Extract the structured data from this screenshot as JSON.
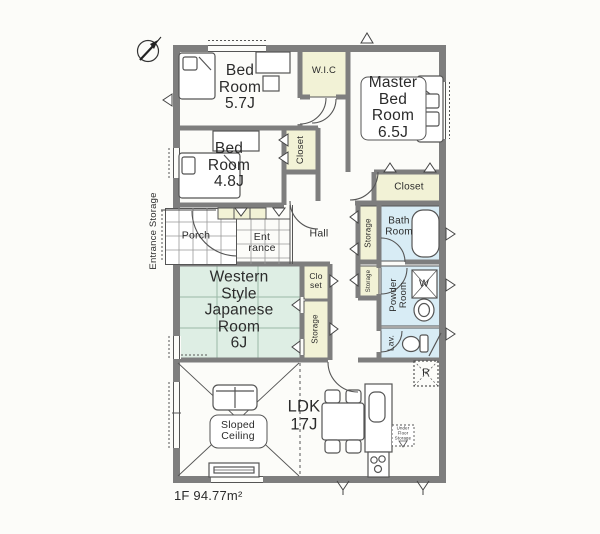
{
  "labels": {
    "bed_room_57": "Bed\nRoom\n5.7J",
    "wic": "W.I.C",
    "master_bed_room": "Master\nBed\nRoom\n6.5J",
    "bed_room_48": "Bed\nRoom\n4.8J",
    "closet_48": "Closet",
    "closet_master": "Closet",
    "entrance_storage": "Entrance Storage",
    "porch": "Porch",
    "entrance": "Ent\nrance",
    "hall": "Hall",
    "storage_bath": "Storage",
    "bath_room": "Bath\nRoom",
    "japanese_room": "Western\nStyle\nJapanese\nRoom\n6J",
    "closet_hall": "Clo\nset",
    "storage_hall": "Storage",
    "storage_powder": "Storage",
    "powder_room": "Powder\nRoom",
    "lav": "Lav.",
    "washer": "W",
    "fridge": "R",
    "under_floor_storage": "Under\nFloor\nStorage",
    "ldk": "LDK\n17J",
    "sloped_ceiling": "Sloped\nCeiling",
    "floor_area": "1F 94.77m²"
  },
  "colors": {
    "wall": "#7e7e7e",
    "line": "#4a4a4a",
    "closet_fill": "#f2f2d6",
    "water_fill": "#d8ecf5",
    "tatami_fill": "#deeee4",
    "background": "#fcfcf9"
  },
  "icons": [
    "compass-north-icon",
    "bed-icon",
    "desk-icon",
    "bathtub-icon",
    "toilet-icon",
    "sink-icon",
    "washing-machine-box",
    "refrigerator-box",
    "under-floor-storage-box",
    "stove-icon",
    "kitchen-counter-icon",
    "dining-set-icon",
    "sofa-icon",
    "tv-board-icon",
    "door-arc",
    "folding-door-chevron",
    "vent-triangle",
    "window"
  ]
}
